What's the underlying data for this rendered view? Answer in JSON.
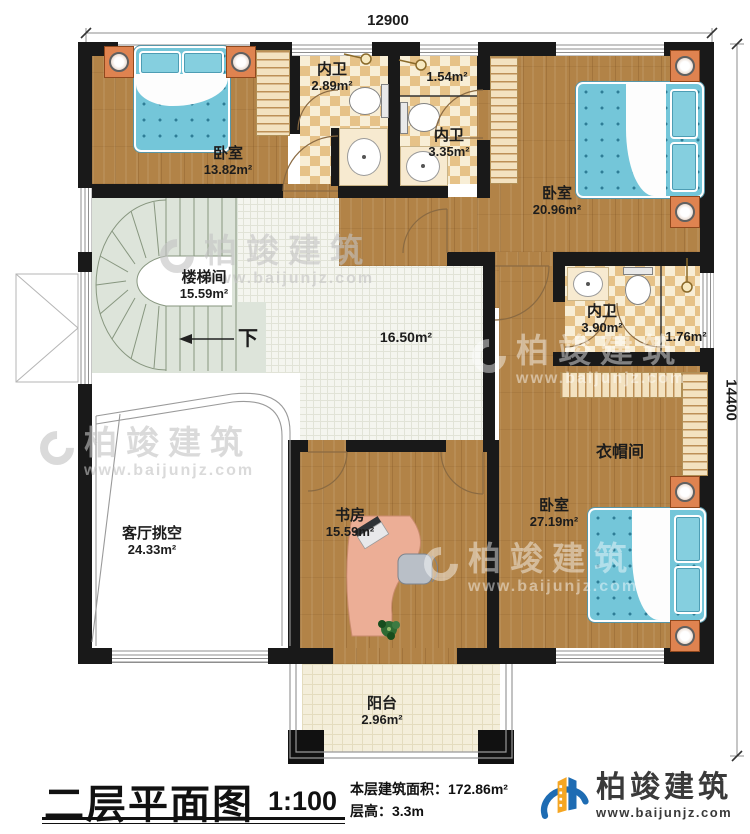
{
  "plan": {
    "dimensions": {
      "top": "12900",
      "right": "14400"
    },
    "rooms": {
      "bedroom_tl": {
        "name": "卧室",
        "area": "13.82m²"
      },
      "bath_tl": {
        "name": "内卫",
        "area": "2.89m²"
      },
      "bath_tc": {
        "name": "内卫",
        "area": "3.35m²",
        "sub_area": "1.54m²"
      },
      "bedroom_tr": {
        "name": "卧室",
        "area": "20.96m²"
      },
      "stairwell": {
        "name": "楼梯间",
        "area": "15.59m²",
        "direction": "下"
      },
      "hall": {
        "area": "16.50m²"
      },
      "bath_mr": {
        "name": "内卫",
        "area": "3.90m²",
        "sub_area": "1.76m²"
      },
      "cloakroom": {
        "name": "衣帽间"
      },
      "bedroom_br": {
        "name": "卧室",
        "area": "27.19m²"
      },
      "study": {
        "name": "书房",
        "area": "15.59m²"
      },
      "living_void": {
        "name": "客厅挑空",
        "area": "24.33m²"
      },
      "balcony": {
        "name": "阳台",
        "area": "2.96m²"
      }
    }
  },
  "footer": {
    "title": "二层平面图",
    "scale": "1:100",
    "area_label": "本层建筑面积：",
    "area_value": "172.86m²",
    "height_label": "层高：",
    "height_value": "3.3m"
  },
  "logo": {
    "name": "柏竣建筑",
    "url": "www.baijunjz.com"
  },
  "watermark": {
    "name": "柏竣建筑",
    "url": "www.baijunjz.com"
  },
  "colors": {
    "wall": "#191919",
    "wood": "#b28347",
    "bed": "#74c6d9",
    "logo_blue": "#1e6cb3",
    "logo_orange": "#f5a623"
  }
}
